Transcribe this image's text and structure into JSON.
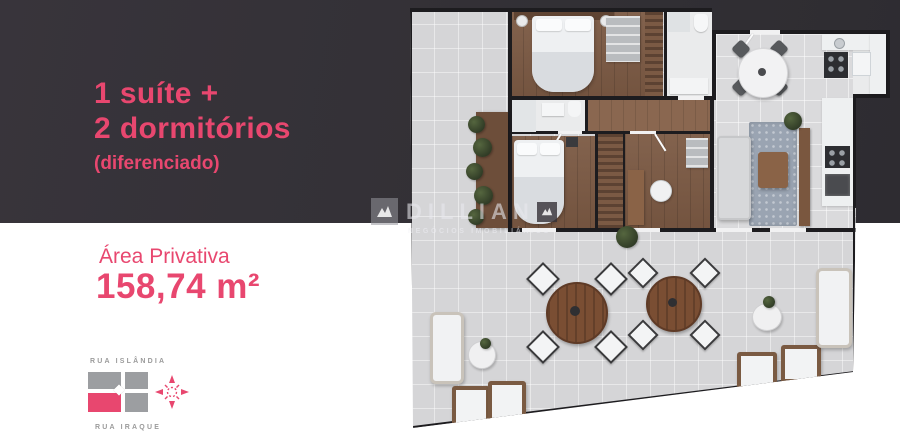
{
  "info_panel": {
    "headline_line1": "1 suíte +",
    "headline_line2": "2 dormitórios",
    "subheadline": "(diferenciado)",
    "area_label": "Área Privativa",
    "area_value": "158,74 m²"
  },
  "location_map": {
    "street_top": "RUA ISLÂNDIA",
    "street_bottom": "RUA IRAQUE",
    "highlighted_block": "bottom-left",
    "compass_icon": "compass-rose-icon"
  },
  "watermark": {
    "brand": "DILLIAN",
    "tagline": "NEGÓCIOS IMOBILIÁRIOS",
    "logo_icon": "house-logo-icon"
  },
  "colors": {
    "accent_pink": "#e8476f",
    "dark_background": "#333036",
    "map_block_gray": "#9c9ea1",
    "plan_terrace_gray": "#d5d5d7",
    "plan_wood_floor": "#7c5a44",
    "plan_wall": "#1d1c1f"
  }
}
